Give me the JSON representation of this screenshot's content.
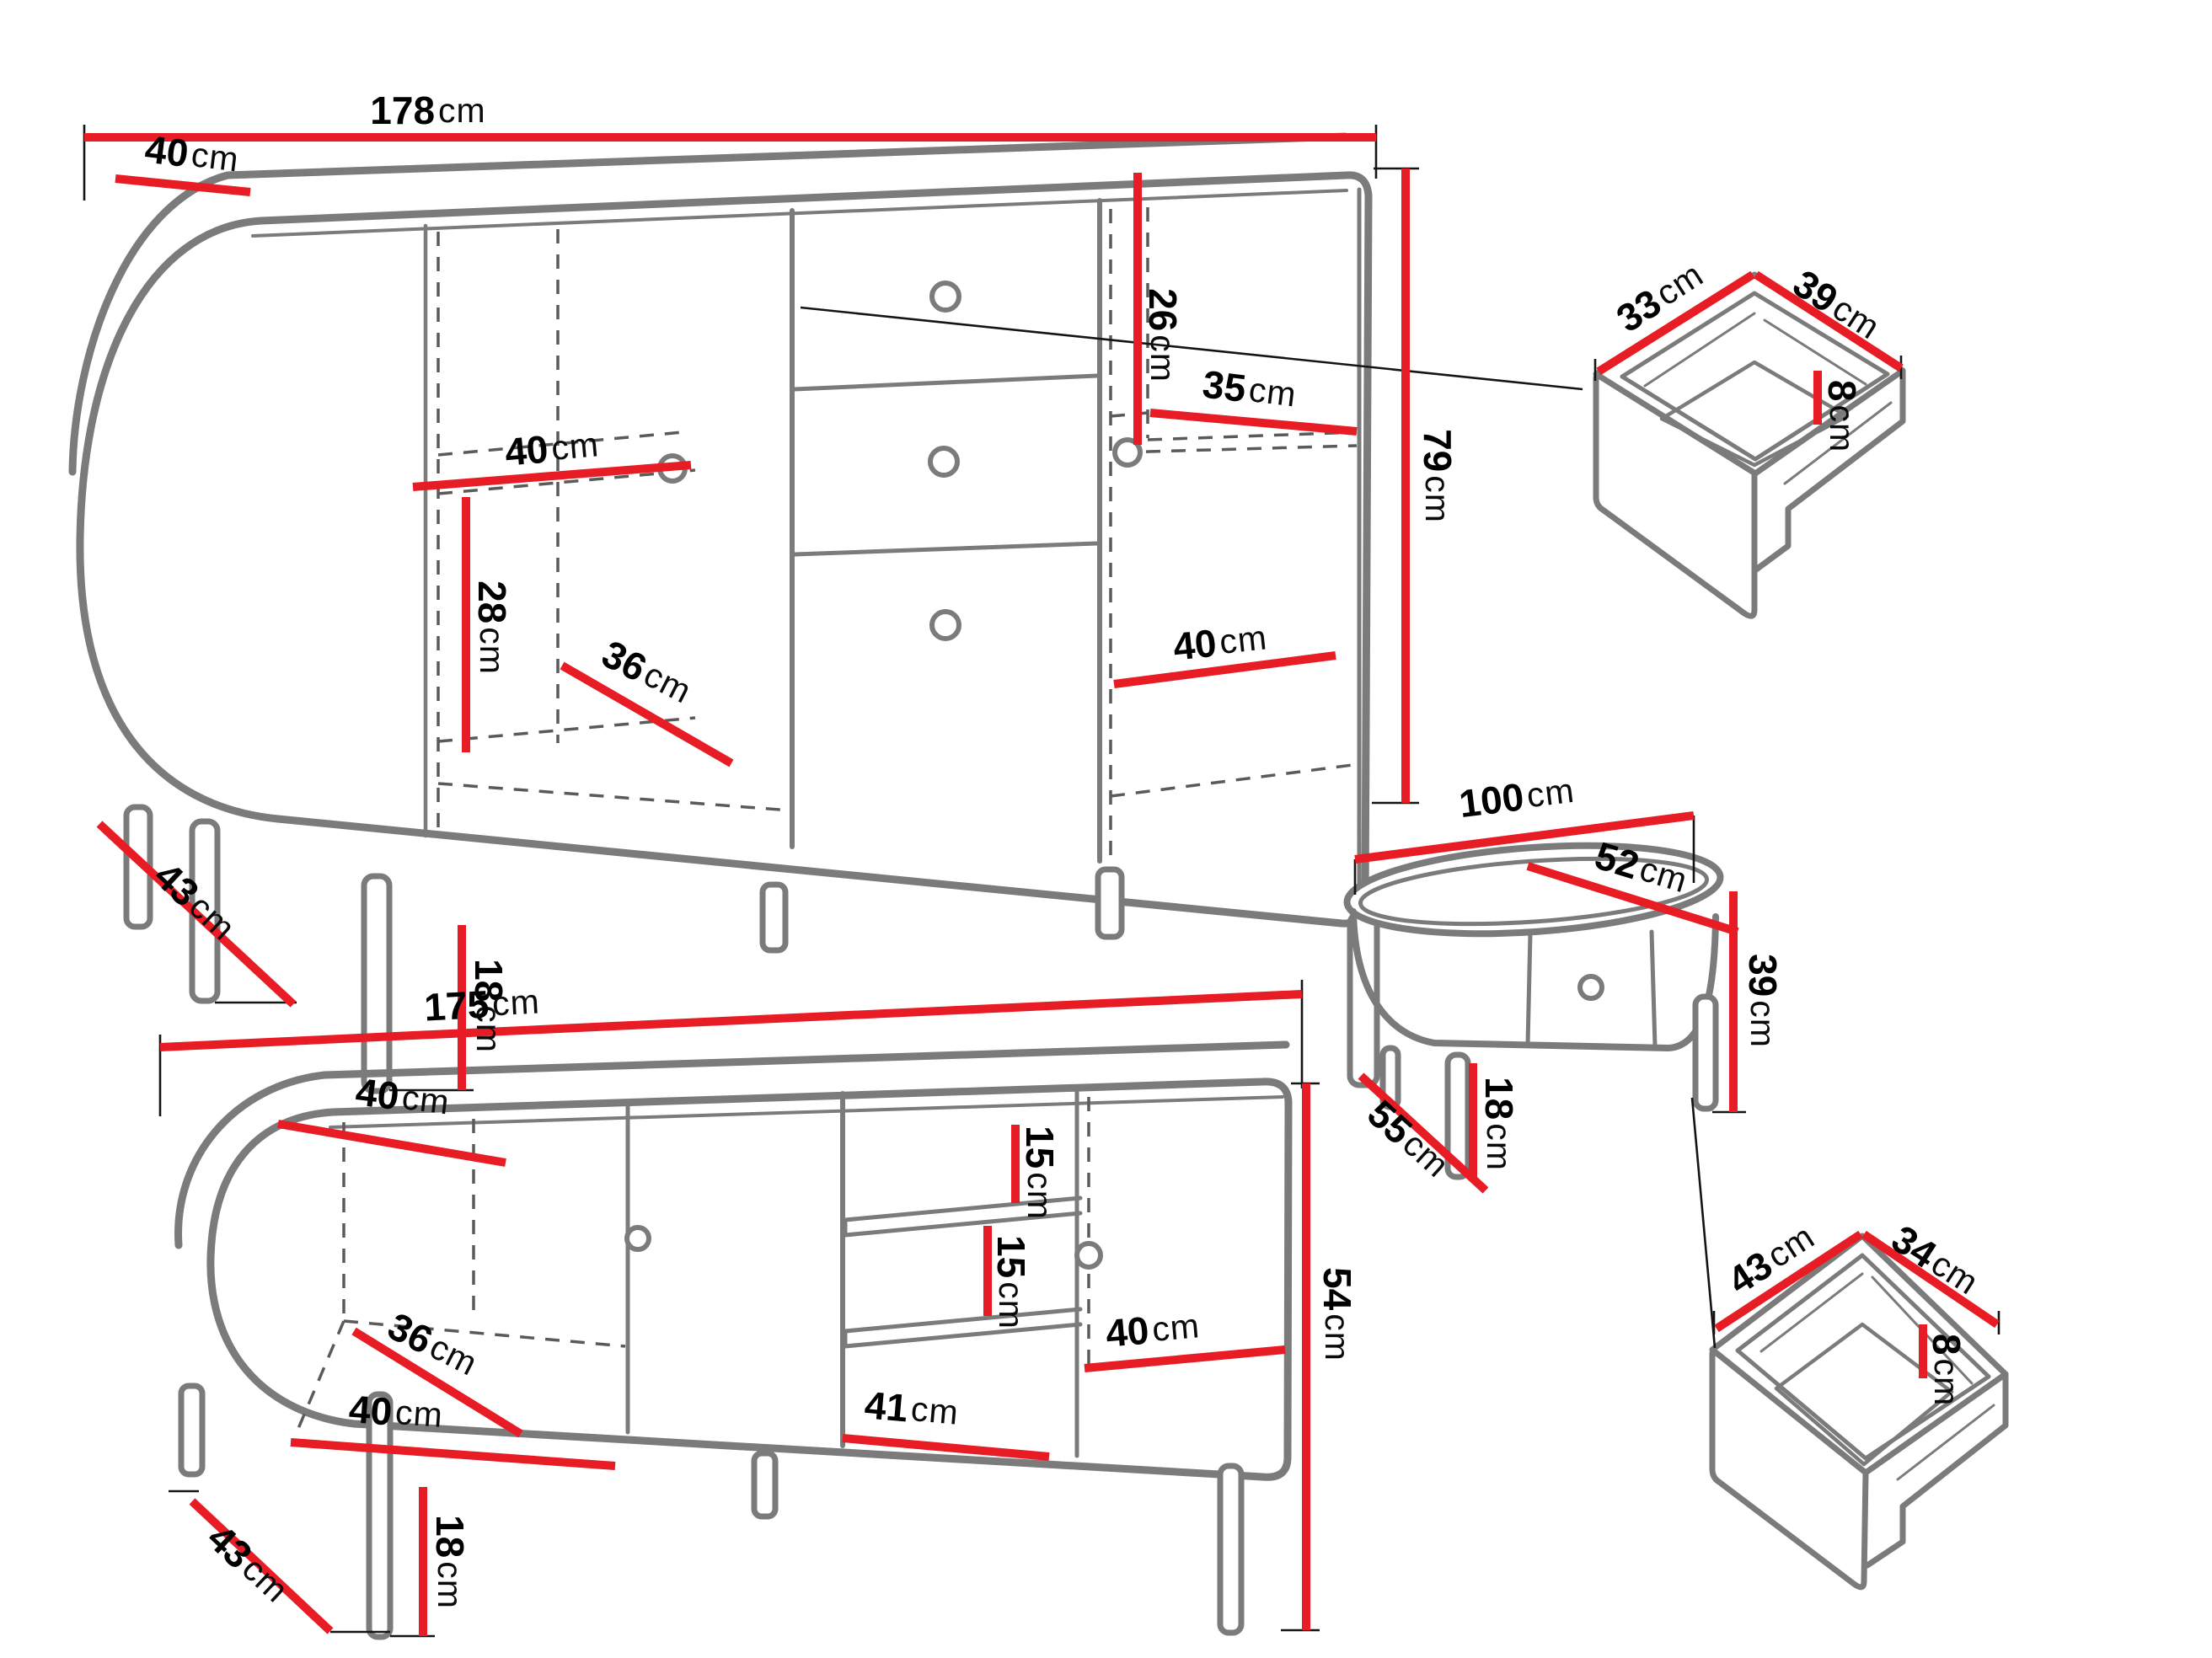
{
  "colors": {
    "dimension_red": "#e81c24",
    "outline_gray": "#7b7b7b",
    "dash_gray": "#5a5a5a",
    "label_black": "#000000",
    "background": "#ffffff"
  },
  "sideboard": {
    "width": {
      "num": "178",
      "unit": "cm"
    },
    "depth": {
      "num": "40",
      "unit": "cm"
    },
    "shelf_width": {
      "num": "40",
      "unit": "cm"
    },
    "upper_right_height": {
      "num": "26",
      "unit": "cm"
    },
    "right_shelf_width": {
      "num": "35",
      "unit": "cm"
    },
    "height": {
      "num": "79",
      "unit": "cm"
    },
    "lower_left_height": {
      "num": "28",
      "unit": "cm"
    },
    "lower_depth": {
      "num": "36",
      "unit": "cm"
    },
    "lower_right_width": {
      "num": "40",
      "unit": "cm"
    },
    "leg_diagonal": {
      "num": "43",
      "unit": "cm"
    },
    "leg_height": {
      "num": "18",
      "unit": "cm"
    }
  },
  "drawer_top_right": {
    "side_left": {
      "num": "33",
      "unit": "cm"
    },
    "side_right": {
      "num": "39",
      "unit": "cm"
    },
    "inner_height": {
      "num": "8",
      "unit": "cm"
    }
  },
  "coffee_table": {
    "width": {
      "num": "100",
      "unit": "cm"
    },
    "top_depth": {
      "num": "52",
      "unit": "cm"
    },
    "height": {
      "num": "39",
      "unit": "cm"
    },
    "base_diagonal": {
      "num": "55",
      "unit": "cm"
    },
    "leg_height": {
      "num": "18",
      "unit": "cm"
    }
  },
  "drawer_bottom_right": {
    "side_left": {
      "num": "43",
      "unit": "cm"
    },
    "side_right": {
      "num": "34",
      "unit": "cm"
    },
    "inner_height": {
      "num": "8",
      "unit": "cm"
    }
  },
  "tv_stand": {
    "width": {
      "num": "175",
      "unit": "cm"
    },
    "depth": {
      "num": "40",
      "unit": "cm"
    },
    "shelf_gap_upper": {
      "num": "15",
      "unit": "cm"
    },
    "shelf_gap_lower": {
      "num": "15",
      "unit": "cm"
    },
    "lower_depth": {
      "num": "36",
      "unit": "cm"
    },
    "lower_left_width": {
      "num": "40",
      "unit": "cm"
    },
    "middle_width": {
      "num": "41",
      "unit": "cm"
    },
    "right_width": {
      "num": "40",
      "unit": "cm"
    },
    "height": {
      "num": "54",
      "unit": "cm"
    },
    "leg_diagonal": {
      "num": "43",
      "unit": "cm"
    },
    "leg_height": {
      "num": "18",
      "unit": "cm"
    }
  }
}
